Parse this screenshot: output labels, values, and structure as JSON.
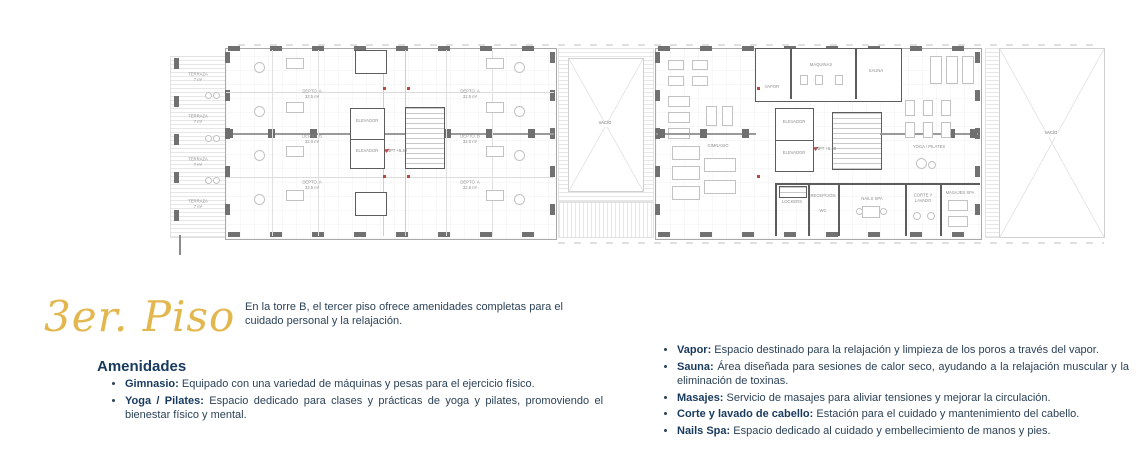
{
  "title": {
    "text": "3er. Piso"
  },
  "intro": {
    "text": "En la torre B, el tercer piso ofrece amenidades completas para el cuidado personal y la relajación."
  },
  "amenities": {
    "heading": "Amenidades",
    "left_items": [
      {
        "label": "Gimnasio:",
        "text": "Equipado con una variedad de máquinas y pesas para el ejercicio físico."
      },
      {
        "label": "Yoga / Pilates:",
        "text": "Espacio dedicado para clases y prácticas de yoga y pilates, promoviendo el bienestar físico y mental."
      }
    ],
    "right_items": [
      {
        "label": "Vapor:",
        "text": "Espacio destinado para la relajación y limpieza de los poros a través del vapor."
      },
      {
        "label": "Sauna:",
        "text": "Área diseñada para sesiones de calor seco, ayudando a la relajación muscular y la eliminación de toxinas."
      },
      {
        "label": "Masajes:",
        "text": "Servicio de masajes para aliviar tensiones y mejorar la circulación."
      },
      {
        "label": "Corte y lavado de cabello:",
        "text": "Estación para el cuidado y mantenimiento del cabello."
      },
      {
        "label": "Nails Spa:",
        "text": "Espacio dedicado al cuidado y embellecimiento de manos y pies."
      }
    ]
  },
  "floor_plan": {
    "labels": {
      "terraza": "TERRAZA",
      "terraza_area": "7 m²",
      "depto_a": "DEPTO. A",
      "depto_a_area": "32.5 m²",
      "depto_b": "DEPTO. B",
      "depto_b_area": "32.0 m²",
      "elevador": "ELEVADOR",
      "npt": "NPT +5.40",
      "vacio": "VACÍO",
      "gimnasio": "GIMNASIO",
      "vapor": "VAPOR",
      "maquinas": "MÁQUINAS",
      "sauna": "SAUNA",
      "yoga": "YOGA / PILATES",
      "lockers": "LOCKERS",
      "recepcion": "RECEPCIÓN",
      "wc": "WC",
      "nails": "NAILS SPA",
      "corte_lavado": "CORTE Y",
      "corte_lavado2": "LAVADO",
      "masajes": "MASAJES SPA"
    }
  },
  "colors": {
    "accent_gold": "#E2B74E",
    "heading_navy": "#17395E",
    "body_text": "#2C4257",
    "plan_wall": "#5D5D5D",
    "plan_marker_red": "#C0453F"
  }
}
